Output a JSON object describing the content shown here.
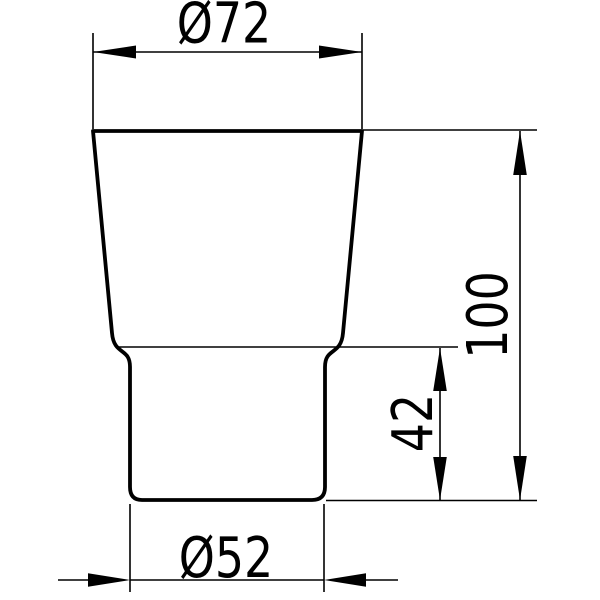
{
  "drawing": {
    "background_color": "#ffffff",
    "line_color": "#000000",
    "labels": {
      "top_diameter": "Ø72",
      "overall_height": "100",
      "base_height": "42",
      "bottom_diameter": "Ø52"
    }
  }
}
